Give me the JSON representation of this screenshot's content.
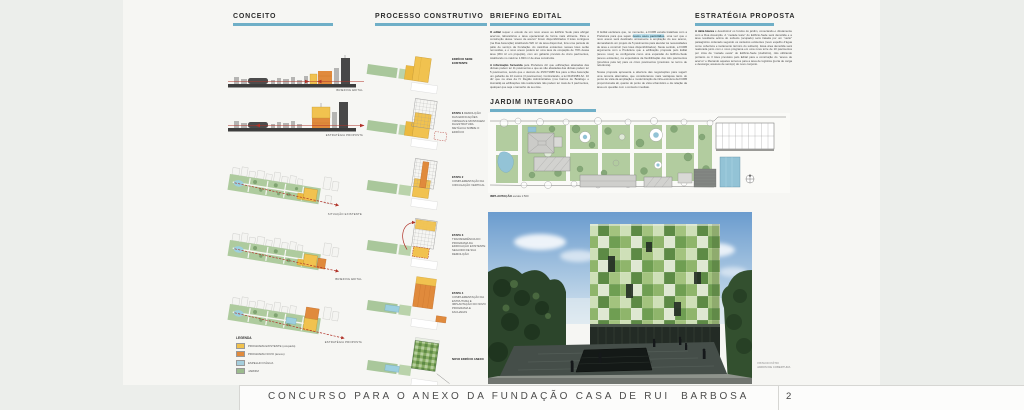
{
  "footer": {
    "title": "CONCURSO PARA O ANEXO DA FUNDAÇÃO CASA DE RUI  BARBOSA",
    "page": "2"
  },
  "conceito": {
    "title": "CONCEITO",
    "skyline_captions": [
      "BRIEFING EDITAL",
      "ESTRATÉGIA PROPOSTA"
    ],
    "axon_captions": [
      "SITUAÇÃO EXISTENTE",
      "BRIEFING EDITAL",
      "ESTRATÉGIA PROPOSTA"
    ],
    "legend": {
      "title": "LEGENDA",
      "items": [
        {
          "label": "PROGRAMA EXISTENTE (ocupado)",
          "color": "#f0c14d"
        },
        {
          "label": "PROGRAMA NOVO (anexo)",
          "color": "#e08a3c"
        },
        {
          "label": "ESPELHO D'ÁGUA",
          "color": "#a5cedd"
        },
        {
          "label": "JARDIM",
          "color": "#9cbb8e"
        }
      ]
    }
  },
  "processo": {
    "title": "PROCESSO CONSTRUTIVO",
    "steps": [
      {
        "lead": "EDIFÍCIO SEDE EXISTENTE",
        "text": ""
      },
      {
        "lead": "ETAPA 1",
        "text": "DEMOLIÇÃO DAS EDIFICAÇÕES VIZINHAS E MONTAGEM DA ESTRUTURA METÁLICA SOBRE O EDIFÍCIO"
      },
      {
        "lead": "ETAPA 2",
        "text": "COMPLEMENTAÇÃO DA CIRCULAÇÃO VERTICAL"
      },
      {
        "lead": "ETAPA 3",
        "text": "TRANSFERÊNCIA DO PROGRAMA DA EDIFICAÇÃO EXISTENTE SEGUIDO DE SUA DEMOLIÇÃO"
      },
      {
        "lead": "ETAPA 4",
        "text": "COMPLEMENTAÇÃO DA ESTRUTURA E IMPLANTAÇÃO DO NOVO PROGRAMA E FACHADAS"
      },
      {
        "lead": "NOVO EDIFÍCIO ANEXO",
        "text": ""
      }
    ]
  },
  "briefing": {
    "title": "BRIEFING EDITAL",
    "col1_p1_lead": "O edital",
    "col1_p1": " requer o estudo de um novo anexo ao Edifício Sede para abrigar acervos, laboratórios e área operacional de forma mais eficiente. Para a construção desse “anexo de acervo” foram disponibilizados 3 lotes contíguos (na Rua Assunção) totalizando 520 m² de área disponível, fora uma parcela do pátio de serviço da Fundação. As casinhas existentes nesses lotes serão removidas, e o novo anexo poderá ter uma taxa de ocupação de 70% dessa área (364 m² em projeção), com um gabarito previsto de cinco pavimentos, totalizando no máximo 1.820 m² de área construída.",
    "col1_p2_lead": "A informação fornecida",
    "col1_p2": " pela Prefeitura diz que edificações afastadas das divisas podem ter 11 pavimentos e que as não afastadas das divisas podem ter 5 pavimentos, sendo que o decreto de 25/07/1988 fixa para a Rua Assunção um gabarito de 10 metros (3 pavimentos). Contrariando, a lei 01M/1983 Art. 10 diz que na área da IV Região Administrativa (nos bairros de Botafogo e Humaitá) as edificações não residenciais não podem ter mais de 3 pavimentos, qualquer que seja o tamanho de seu lote.",
    "col2_p1a": "O Edital esclarece que, no momento, a FCRB estuda tratativas com a Prefeitura para que sejam ",
    "col2_p1_hl": "novos usos permitidos",
    "col2_p1b": ", uma vez que o novo anexo será destinado unicamente à ampliação do seu acervo, demandando um projeto de 5 pavimentos para atender às necessidades de área e construir (nos lotes disponibilizados). Neste sentido, a FCRB argumenta com a Prefeitura que a edificação proposta pelo Edital (anexo novo) se configuraria como uma expansão do Edifício-Sede (anexo existente), na expectativa da flexibilização dos três pavimentos (previstos pela lei) para os cinco pavimentos (previstos no termo de referência).",
    "col2_p2": "Nossa proposta apresenta a abertura das negociações para sugerir uma terceira alternativa, que consideramos mais vantajosa tanto do ponto de vista da ampliação e modernização da infra-estrutura da FCRB proporcionada ali, quanto do ponto de vista urbanístico e da relação da área em questão com o contexto imediato."
  },
  "estrategia": {
    "title": "ESTRATÉGIA PROPOSTA",
    "lead": "A idéia básica",
    "body": " é desobstruir os fundos do jardim, conectando-o diretamente com a Rua Assunção. A “metade leste” do Edifício-Sede será demolida e a área resultante acima do subsolo (ocupado) será tratada por um “vazio” paisagístico ordenado segundo os canteiros existentes (novo espelho d'água como cobertura e isolamento térmico do subsolo). Essa área demolida será realocada junto com o novo programa em uma nova torre de 10 pavimentos por cima da “metade oeste” do Edifício-Sede (Auditório), não utilizando portanto os 3 lotes previstos pelo Edital para a construção do “anexo de acervo” e liberando aqueles terrenos para a área de logística (porta de carga e descarga; acessos de serviço) do novo conjunto."
  },
  "jardim": {
    "title": "JARDIM INTEGRADO",
    "plan_caption_lead": "IMPLANTAÇÃO",
    "plan_caption": " escala 1:500",
    "photo_caption1": "VISTA DO PÁTIO",
    "photo_caption2": "JARDIM DE COBERTURA"
  }
}
